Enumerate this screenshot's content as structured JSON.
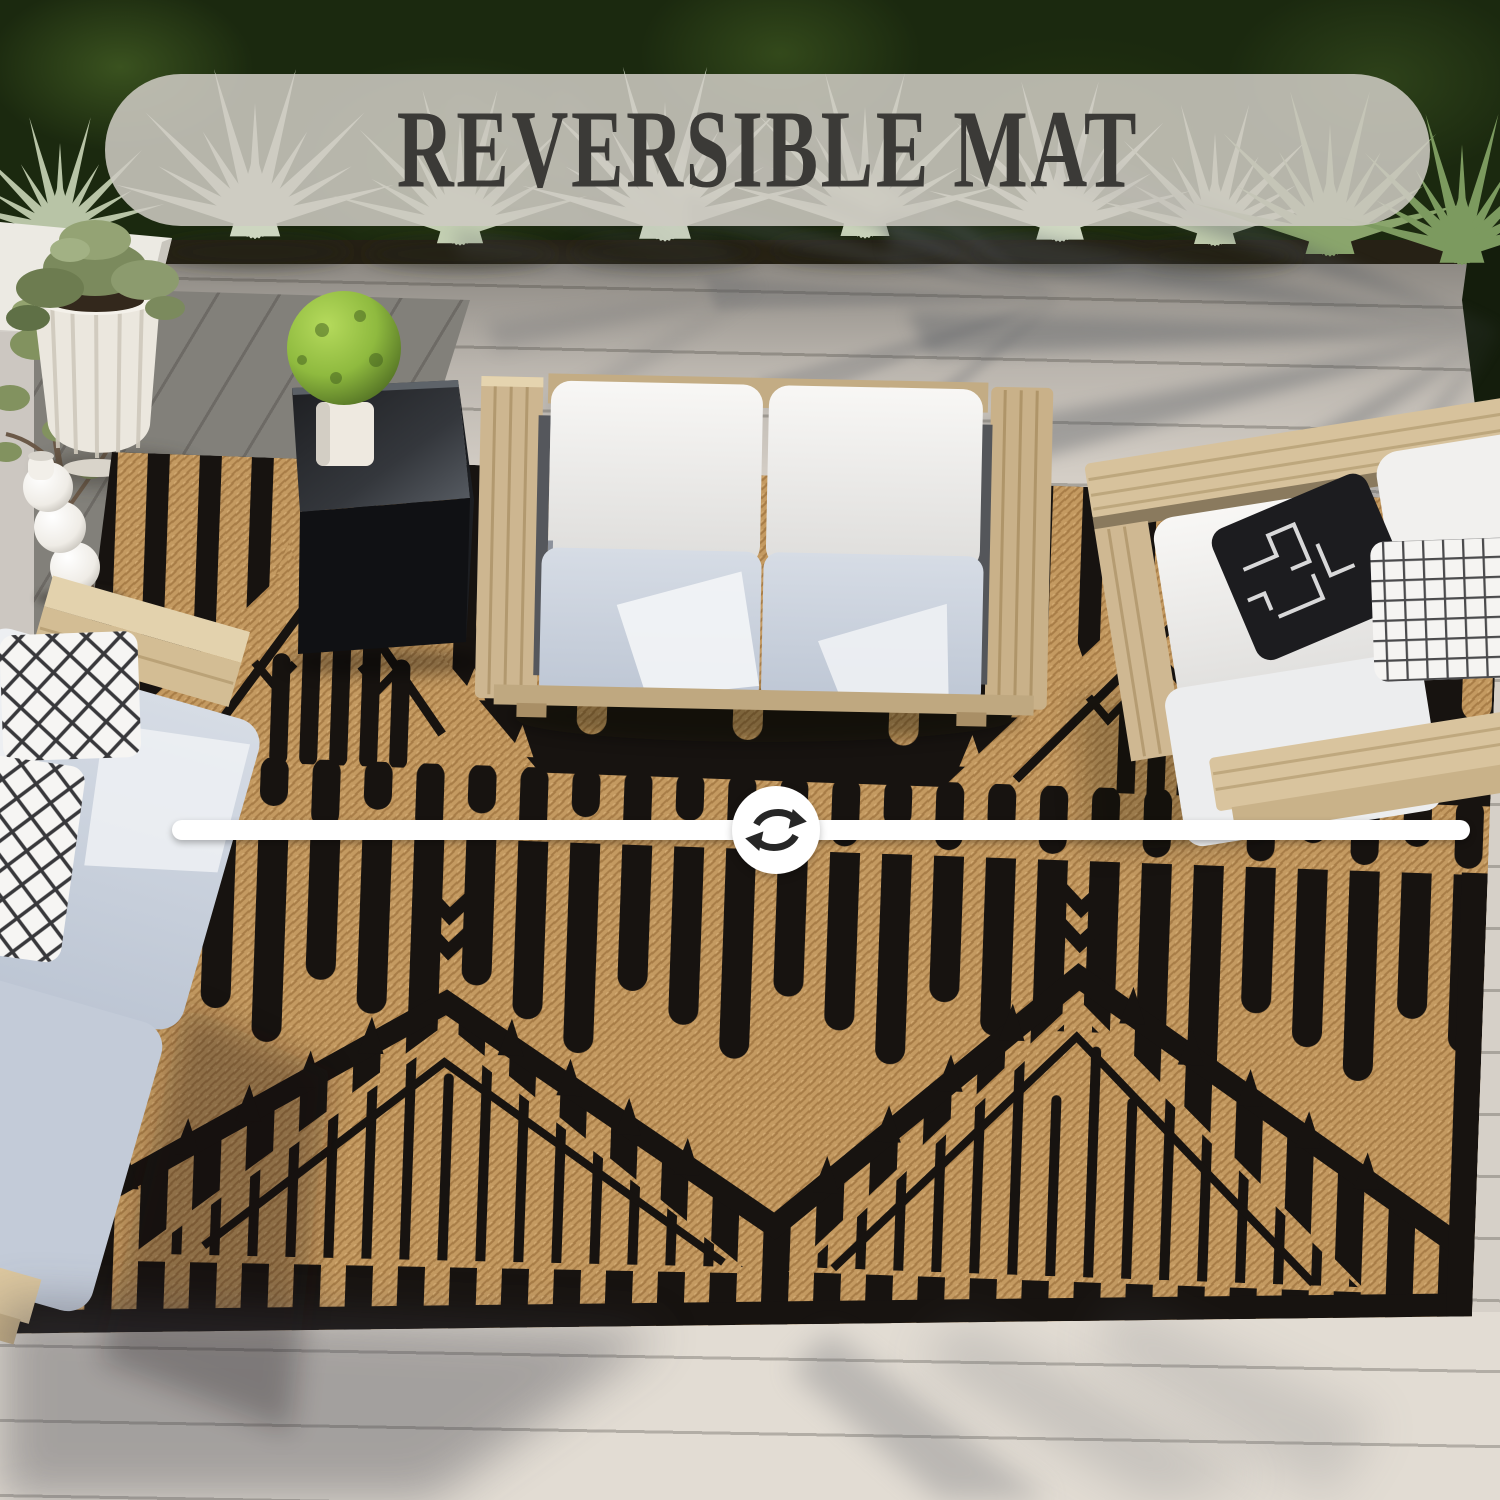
{
  "banner": {
    "label": "REVERSIBLE MAT"
  },
  "divider": {
    "icon": "reverse-arrows-icon"
  },
  "colors": {
    "rug_black": "#171310",
    "rug_tan": "#c49a61",
    "divider_bar": "#ffffff",
    "banner_bg": "#cfcbc3",
    "banner_text": "#3b3a37",
    "deck": "#d6d0c8",
    "cushion_white": "#f4f3f1",
    "cushion_gray": "#c6cdd9",
    "wood": "#d2bc96",
    "topiary_green": "#8fba3f"
  }
}
